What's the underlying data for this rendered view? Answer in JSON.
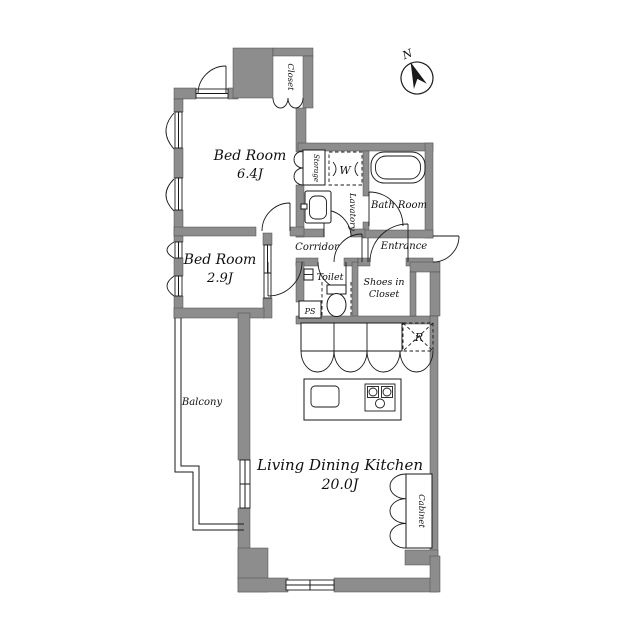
{
  "plan": {
    "compass": {
      "north": "N"
    },
    "labels": {
      "closet": "Closet",
      "bedroom1_name": "Bed Room",
      "bedroom1_size": "6.4J",
      "storage": "Storage",
      "washer": "W",
      "lavatory": "Lavatory",
      "bathroom": "Bath Room",
      "corridor": "Corridor",
      "entrance": "Entrance",
      "bedroom2_name": "Bed Room",
      "bedroom2_size": "2.9J",
      "toilet": "Toilet",
      "ps": "PS",
      "shoes_closet_line1": "Shoes in",
      "shoes_closet_line2": "Closet",
      "refrigerator": "R",
      "balcony": "Balcony",
      "ldk_name": "Living Dining Kitchen",
      "ldk_size": "20.0J",
      "cabinet": "Cabinet"
    },
    "colors": {
      "wall": "#8d8d8d",
      "line": "#1a1a1a",
      "ps_fill": "#aeaeae",
      "background": "#ffffff"
    }
  }
}
